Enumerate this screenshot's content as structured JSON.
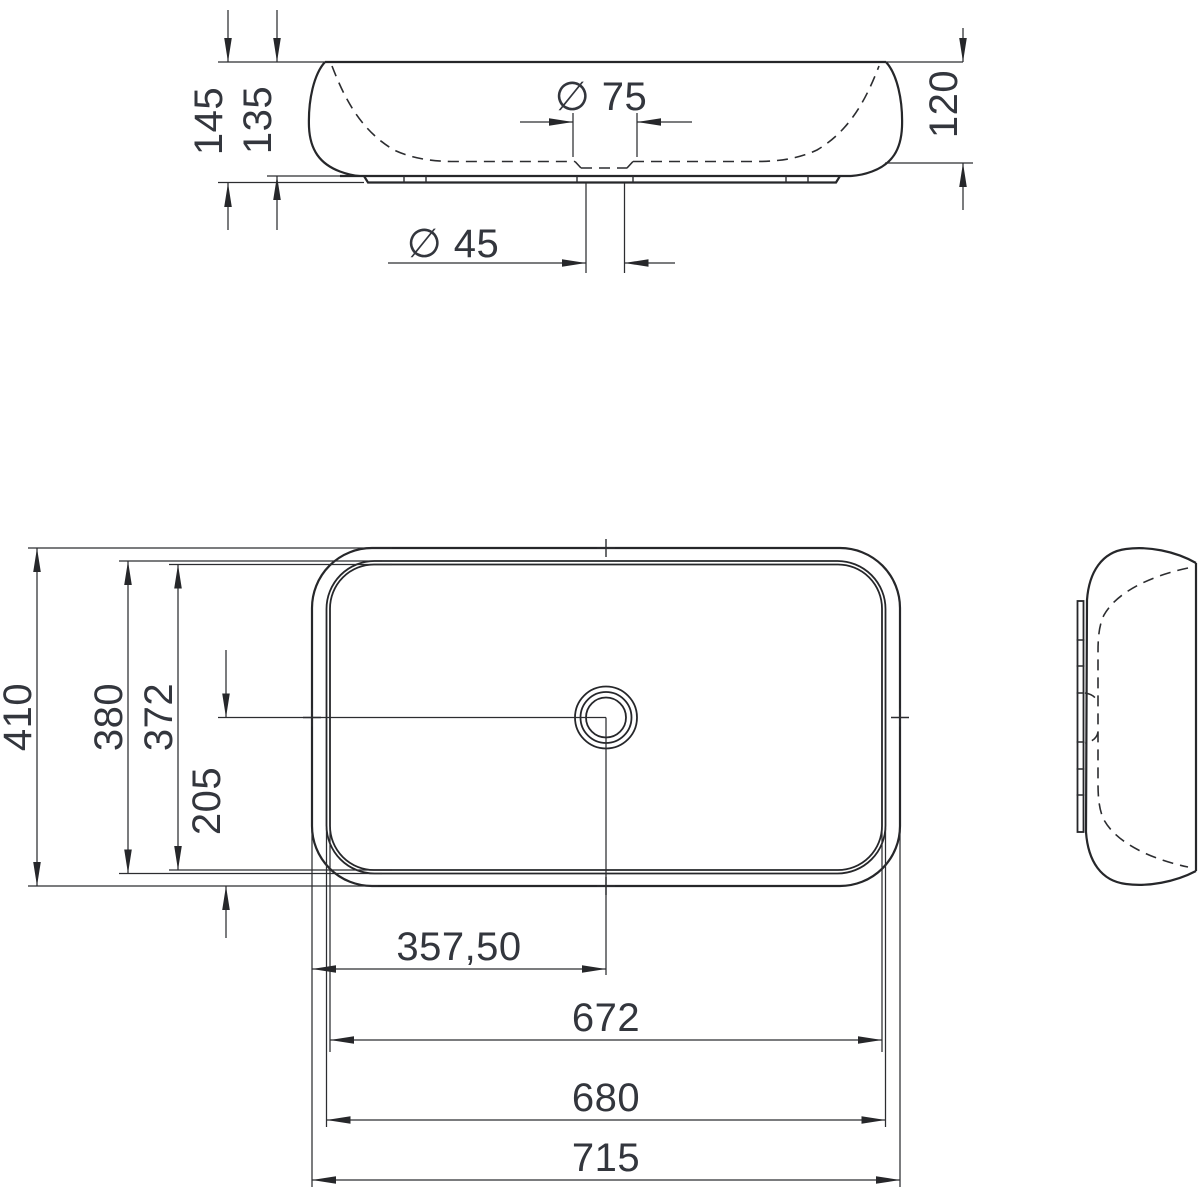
{
  "drawing": {
    "front_view": {
      "dim_total_height": "145",
      "dim_body_height": "135",
      "dim_bowl_depth": "120",
      "dim_drain_top": "∅ 75",
      "dim_drain_waste": "∅ 45"
    },
    "plan_view": {
      "dim_depth_outer": "410",
      "dim_depth_rim": "380",
      "dim_depth_inner": "372",
      "dim_center_offset": "205",
      "dim_drain_center": "357,50",
      "dim_width_inner": "672",
      "dim_width_rim": "680",
      "dim_width_outer": "715"
    },
    "colors": {
      "line": "#26272a",
      "text": "#33363d",
      "background": "#ffffff"
    }
  }
}
